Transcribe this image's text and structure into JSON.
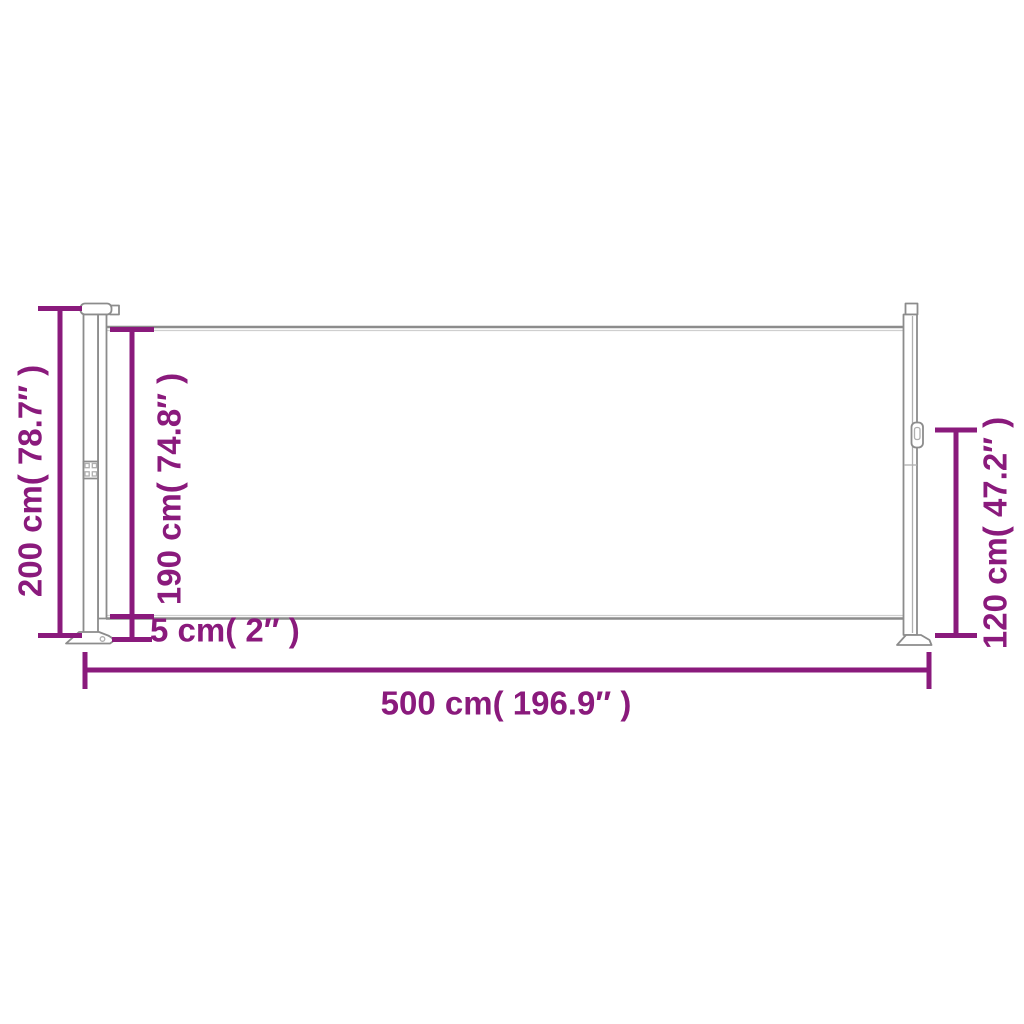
{
  "colors": {
    "dimension_accent": "#8A1A7C",
    "drawing_line": "#8C8C8C",
    "background": "#FFFFFF"
  },
  "dimensions": {
    "total_height": "200 cm( 78.7″ )",
    "fabric_height": "190 cm( 74.8″ )",
    "ground_clearance": "5 cm( 2″ )",
    "total_width": "500 cm( 196.9″ )",
    "rear_post_height": "120 cm( 47.2″ )"
  }
}
